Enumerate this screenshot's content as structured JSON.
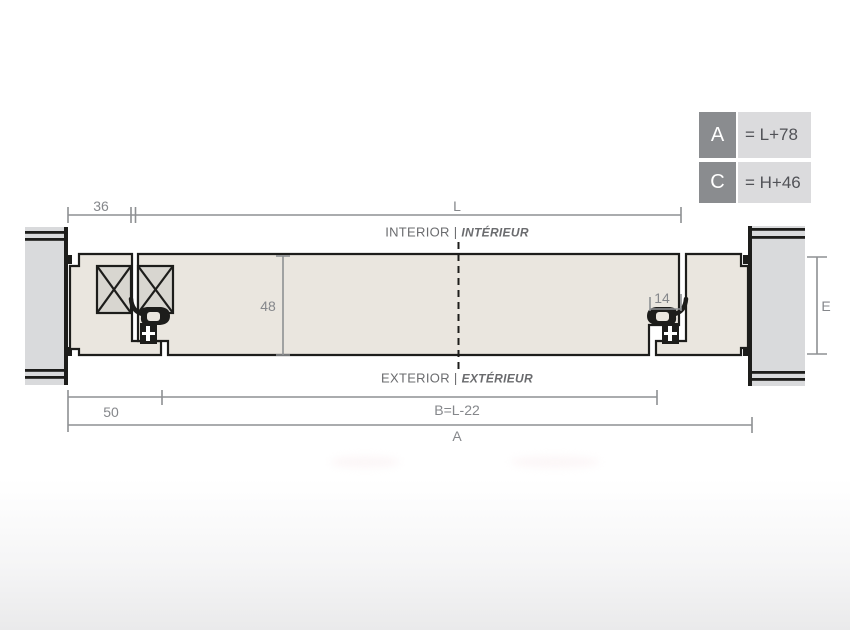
{
  "legend": {
    "rows": [
      {
        "key": "A",
        "value": "= L+78"
      },
      {
        "key": "C",
        "value": "= H+46"
      }
    ]
  },
  "zones": {
    "interior": {
      "en": "INTERIOR",
      "sep": "|",
      "fr": "INTÉRIEUR"
    },
    "exterior": {
      "en": "EXTERIOR",
      "sep": "|",
      "fr": "EXTÉRIEUR"
    }
  },
  "dimensions": {
    "frame_offset": "36",
    "opening_width": "L",
    "profile_depth": "48",
    "overlap": "14",
    "sill_offset": "50",
    "outer_width_formula": "B=L-22",
    "total_width": "A",
    "wall_reveal": "E"
  },
  "colors": {
    "outline": "#1d1d1b",
    "profile_fill": "#eae6df",
    "insulation_fill": "#d8d6d0",
    "wall_fill": "#d9dadc",
    "dimension_line": "#8e9093",
    "dimension_text": "#85878b",
    "zone_text": "#6a6b6e",
    "legend_key_bg": "#8a8c8f",
    "legend_key_text": "#ffffff",
    "legend_value_bg": "#dbdbdd",
    "legend_value_text": "#515257"
  }
}
